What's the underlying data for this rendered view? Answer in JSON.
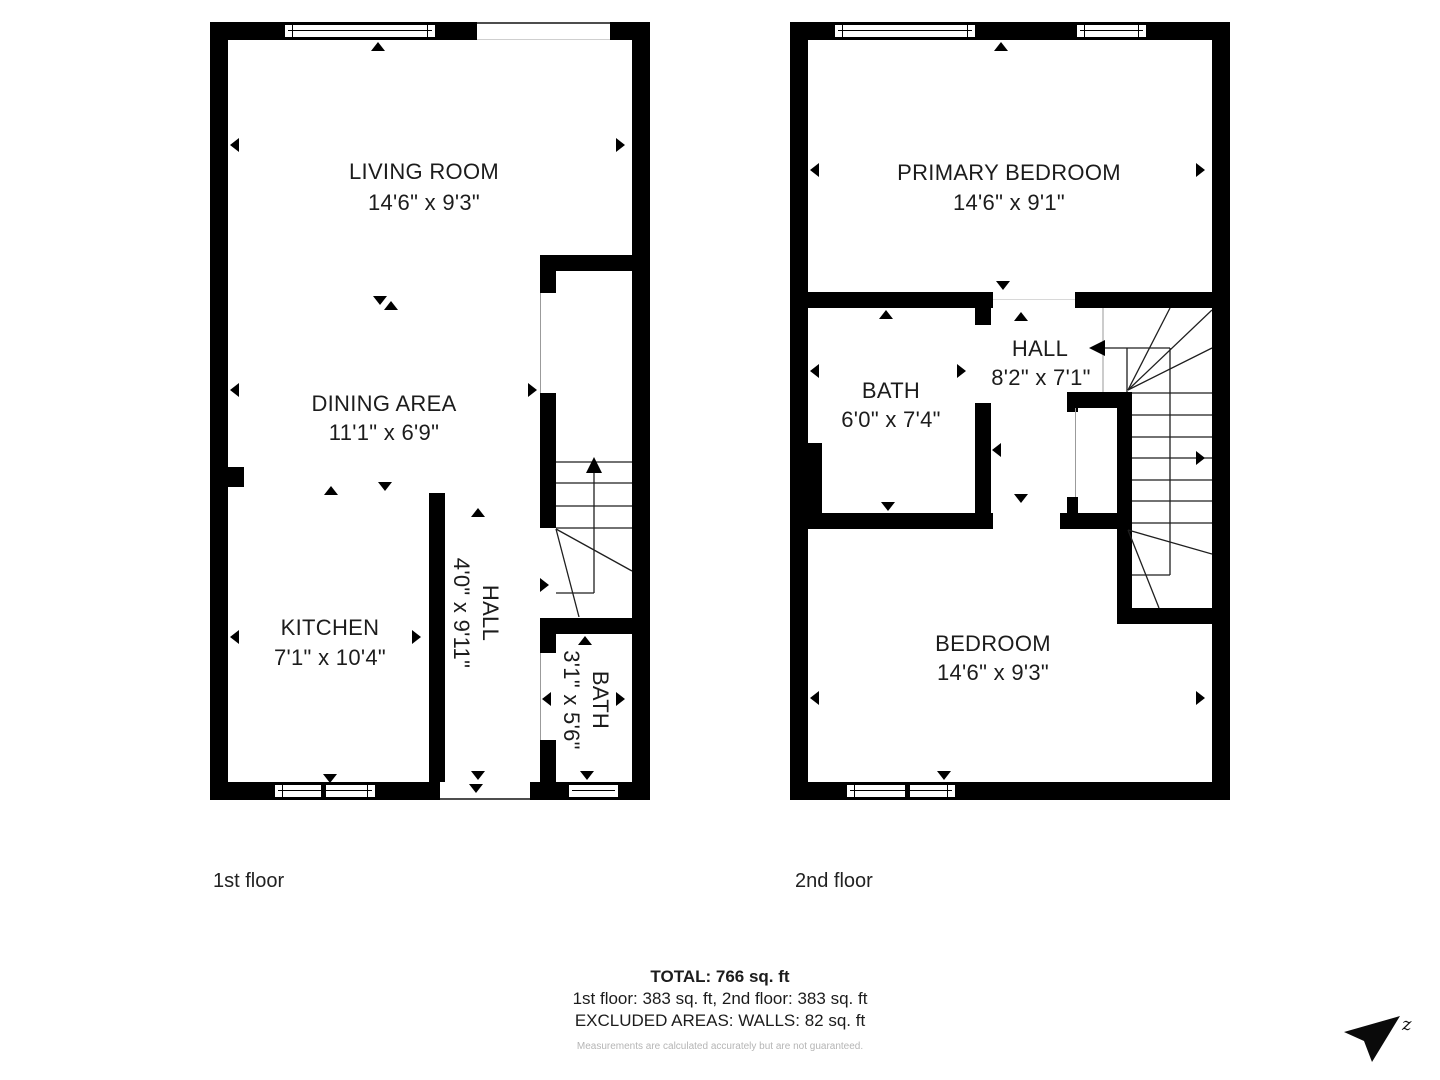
{
  "floors": [
    {
      "label": "1st floor",
      "rooms": [
        {
          "name": "LIVING ROOM",
          "dims": "14'6\" x 9'3\""
        },
        {
          "name": "DINING AREA",
          "dims": "11'1\" x 6'9\""
        },
        {
          "name": "KITCHEN",
          "dims": "7'1\" x 10'4\""
        },
        {
          "name": "HALL",
          "dims": "4'0\" x 9'11\""
        },
        {
          "name": "BATH",
          "dims": "3'1\" x 5'6\""
        }
      ]
    },
    {
      "label": "2nd floor",
      "rooms": [
        {
          "name": "PRIMARY BEDROOM",
          "dims": "14'6\" x 9'1\""
        },
        {
          "name": "BATH",
          "dims": "6'0\" x 7'4\""
        },
        {
          "name": "HALL",
          "dims": "8'2\" x 7'1\""
        },
        {
          "name": "BEDROOM",
          "dims": "14'6\" x 9'3\""
        }
      ]
    }
  ],
  "summary": {
    "total": "TOTAL: 766 sq. ft",
    "floors_line": "1st floor: 383 sq. ft, 2nd floor: 383 sq. ft",
    "excluded_line": "EXCLUDED AREAS: WALLS: 82 sq. ft",
    "disclaimer": "Measurements are calculated accurately but are not guaranteed."
  },
  "compass": {
    "letter": "z"
  },
  "colors": {
    "wall": "#000000",
    "text": "#1c1c1c",
    "muted": "#b5b5b5"
  }
}
